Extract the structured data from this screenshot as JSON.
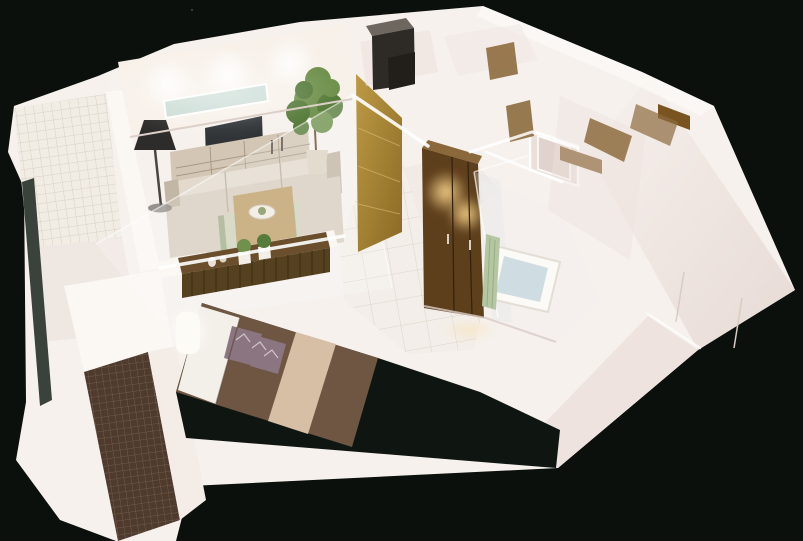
{
  "meta": {
    "title": "3D isometric cutaway render of a one-bedroom apartment floor plan on a dark background",
    "render_style": "photorealistic dollhouse / bird's-eye architectural visualization"
  },
  "scene": {
    "type": "3d-floor-plan-render",
    "rooms": [
      {
        "name": "Living room",
        "objects": [
          "beige sofa",
          "armchair",
          "chaise",
          "wooden coffee table with bowl",
          "green striped rug",
          "media console with candlesticks",
          "wall-mounted TV",
          "long window strip",
          "black floor lamp",
          "tall potted plant",
          "three ceiling light glows"
        ]
      },
      {
        "name": "Bedroom",
        "objects": [
          "double bed with brown cover",
          "white pillows",
          "two patterned cushions",
          "beige bed runner",
          "glowing cylindrical bedside lamp",
          "long wooden sideboard with two potted plants",
          "dark floor"
        ]
      },
      {
        "name": "Upper balcony",
        "objects": [
          "white mosaic tile floor",
          "dark railing"
        ]
      },
      {
        "name": "Lower balcony",
        "objects": [
          "brown mosaic tile floor"
        ]
      },
      {
        "name": "Hallway",
        "objects": [
          "white tile floor",
          "tall gold wood panel",
          "brown wardrobe with warm spotlights"
        ]
      },
      {
        "name": "Bathroom",
        "objects": [
          "white bathtub with water",
          "hanging green towel",
          "glass shower screen",
          "white door frame"
        ]
      },
      {
        "name": "Entrance and storage",
        "objects": [
          "dark tall cabinet",
          "wood floor patches through doorways",
          "brown door transoms"
        ]
      },
      {
        "name": "Second room",
        "objects": [
          "white walls",
          "wood floor patches"
        ]
      }
    ]
  },
  "colors": {
    "background": "#0b100d",
    "wall_white": "#f6f1ed",
    "wall_warm": "#f8f1ea",
    "wall_shade": "#eee3de",
    "wall_bright": "#fbf7f3",
    "railing": "#3a423c",
    "tile_white": "#f1ece4",
    "tile_grout": "#d9d0c3",
    "tile_brown": "#4e3b2d",
    "tile_brown_grout": "#7b6350",
    "hall_tile": "#f3eee9",
    "hall_grout": "#ded3c9",
    "window_glass": "#cbdcd5",
    "tv": "#2f3336",
    "console": "#d3c6b4",
    "sofa": "#d8cec0",
    "sofa_shade": "#c2b6a4",
    "rug_light": "#ced3ba",
    "rug_green": "#9aa982",
    "table_wood": "#c0a06a",
    "lamp_dark": "#2e2c2a",
    "plant_green": "#6f914d",
    "plant_dark": "#567b3a",
    "gold_light": "#bd9a45",
    "gold_dark": "#8a6a24",
    "wardrobe": "#5e3f1c",
    "wardrobe_top": "#8a683c",
    "glow_warm": "#ffd98f",
    "glow_white": "#ffffff",
    "bed": "#6e5643",
    "runner": "#d7bfa5",
    "pillow": "#8b7581",
    "pillow_white": "#f3efe9",
    "bed_lamp": "#fdfbf6",
    "dark_floor": "#0f1612",
    "sideboard": "#6b4f2c",
    "sideboard_front": "#55401f",
    "tub_white": "#fbfaf7",
    "tub_water": "#cfdde2",
    "towel": "#b4c6a2",
    "cabinet": "#2e2a26",
    "cabinet_top": "#6e675f",
    "wood_floor": "#8d6b3e",
    "door_brown": "#7a5420"
  }
}
